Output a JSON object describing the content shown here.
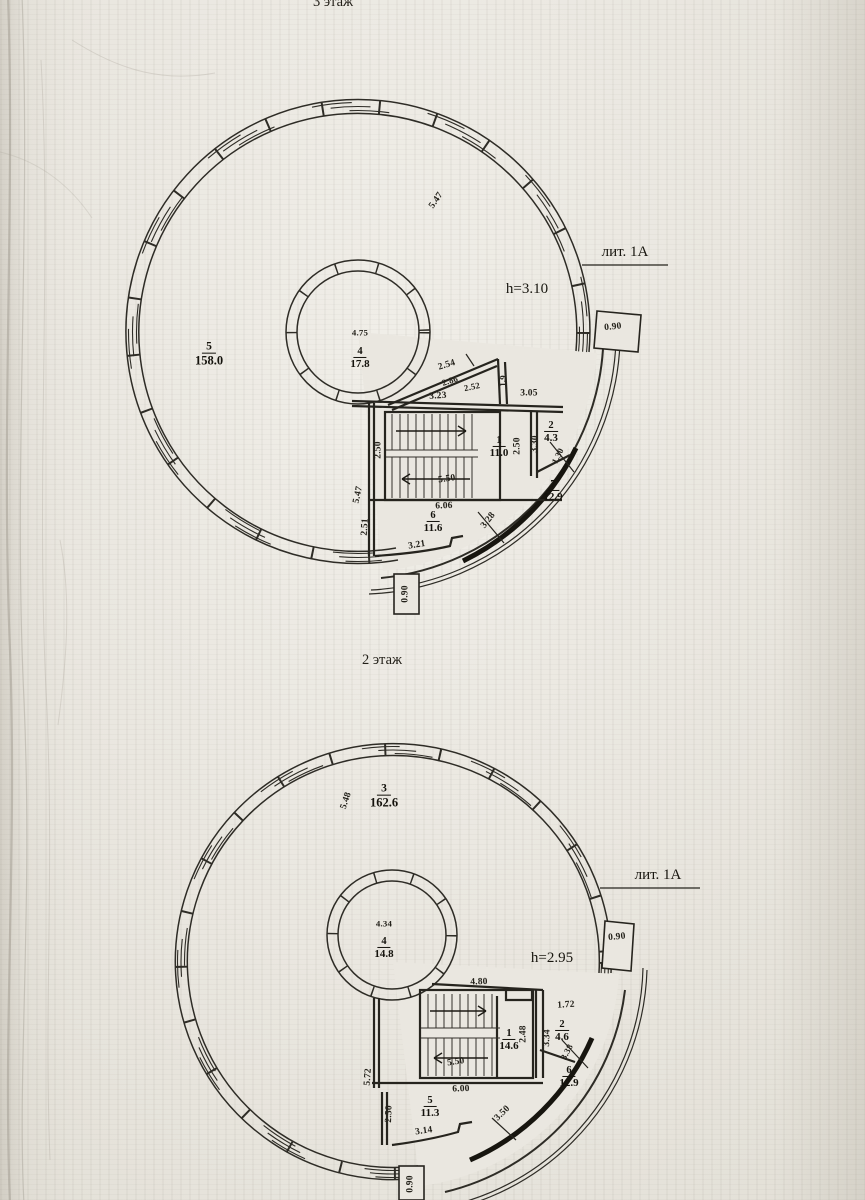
{
  "document": {
    "floor3_title": "3 этаж",
    "floor2_title": "2 этаж"
  },
  "plan3": {
    "building_label": "лит. 1А",
    "ceiling_height": "h=3.10",
    "rooms": {
      "r1": {
        "num": "1",
        "area": "11.0"
      },
      "r2": {
        "num": "2",
        "area": "4.3"
      },
      "r4": {
        "num": "4",
        "area": "17.8"
      },
      "r5": {
        "num": "5",
        "area": "158.0"
      },
      "r6": {
        "num": "6",
        "area": "11.6"
      },
      "r7": {
        "num": "7",
        "area": "12.9"
      }
    },
    "dims": {
      "top_diag": "5.47",
      "core_width": "4.75",
      "tri_outer": "2.54",
      "tri_hyp": "2.86",
      "tri_inner": "2.52",
      "tri_base": "3.23",
      "tri_side": "1.9",
      "corridor": "3.05",
      "stairs_left": "2.50",
      "stairs_width": "5.50",
      "room1_depth": "2.50",
      "room2_depth": "3.30",
      "room2_diag": "1.30",
      "hall_width": "6.06",
      "left_diag": "5.47",
      "room6_left": "2.51",
      "room6_bottom": "3.21",
      "arc_seg": "3.28",
      "entry_right": "0.90",
      "entry_bottom": "0.90"
    }
  },
  "plan2": {
    "building_label": "лит. 1А",
    "ceiling_height": "h=2.95",
    "rooms": {
      "r1": {
        "num": "1",
        "area": "14.6"
      },
      "r2": {
        "num": "2",
        "area": "4.6"
      },
      "r3": {
        "num": "3",
        "area": "162.6"
      },
      "r4": {
        "num": "4",
        "area": "14.8"
      },
      "r5": {
        "num": "5",
        "area": "11.3"
      },
      "r6": {
        "num": "6",
        "area": "12.9"
      }
    },
    "dims": {
      "left_diag": "5.48",
      "core_width": "4.34",
      "stairs_top": "4.80",
      "room2_top": "1.72",
      "room1_depth": "2.48",
      "wall_right": "3.34",
      "room2_diag": "3.38",
      "stairs_width": "5.50",
      "hall_width": "6.00",
      "left_wall": "5.72",
      "room5_left": "2.50",
      "room5_bottom": "3.14",
      "arc_seg": "3.50",
      "entry_right": "0.90",
      "entry_bottom": "0.90"
    }
  }
}
